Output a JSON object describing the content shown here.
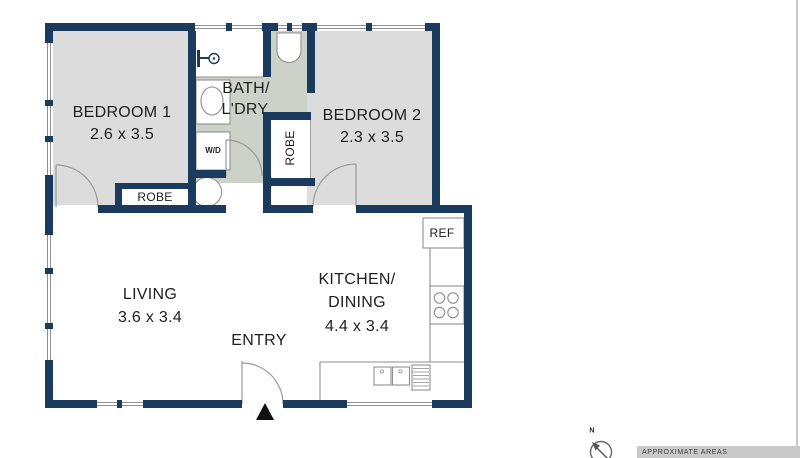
{
  "colors": {
    "wall": "#1a3a5e",
    "bedroom_floor": "#dcdcdc",
    "bath_floor": "#ccd2c8",
    "outline": "#8f8f8f",
    "banner_bg": "#c9c9c9"
  },
  "rooms": {
    "bedroom1": {
      "name": "BEDROOM 1",
      "dimensions": "2.6 x 3.5"
    },
    "bath_laundry": {
      "name_line1": "BATH/",
      "name_line2": "L'DRY"
    },
    "bedroom2": {
      "name": "BEDROOM 2",
      "dimensions": "2.3 x 3.5"
    },
    "living": {
      "name": "LIVING",
      "dimensions": "3.6 x 3.4"
    },
    "kitchen_dining": {
      "name_line1": "KITCHEN/",
      "name_line2": "DINING",
      "dimensions": "4.4 x 3.4"
    },
    "entry": {
      "name": "ENTRY"
    }
  },
  "fixtures": {
    "bedroom1_robe": "ROBE",
    "bedroom2_robe": "ROBE",
    "washer_dryer": "W/D",
    "fridge": "REF"
  },
  "annotations": {
    "areas_note": "APPROXIMATE AREAS",
    "compass_north": "N"
  },
  "icons": {
    "shower-icon": "wall-mounted shower head glyph",
    "toilet-icon": "U-shaped toilet bowl",
    "pedestal-sink-icon": "oval basin in alcove",
    "laundry-tub-icon": "round tub circle",
    "cooktop-icon": "four burner circles",
    "kitchen-sink-icon": "double-bowl sink",
    "dishwasher-icon": "hatched appliance box",
    "entry-arrow-icon": "solid up triangle",
    "compass-icon": "circle with north arrow"
  }
}
